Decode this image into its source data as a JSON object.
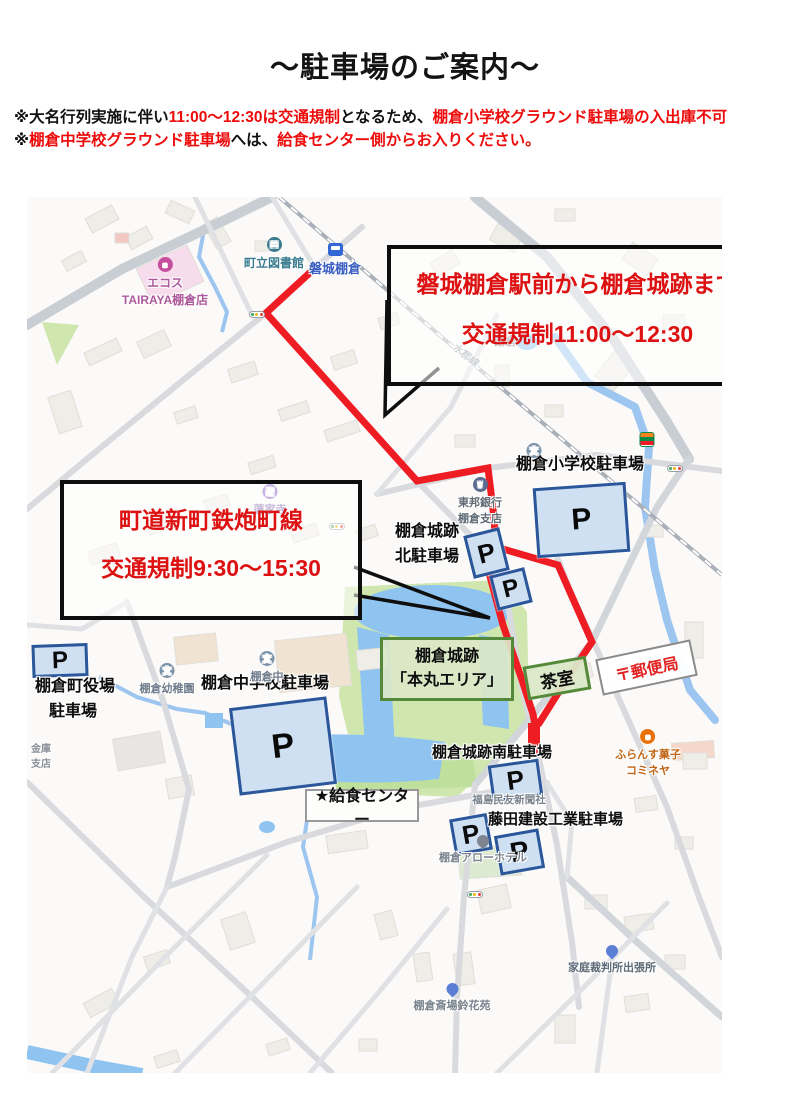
{
  "title": "～駐車場のご案内～",
  "notices": [
    {
      "segments": [
        {
          "text": "※大名行列実施に伴い",
          "color": "black"
        },
        {
          "text": "11:00～12:30は交通規制",
          "color": "red"
        },
        {
          "text": "となるため、",
          "color": "black"
        },
        {
          "text": "棚倉小学校グラウンド駐車場の入出庫不可",
          "color": "red"
        }
      ]
    },
    {
      "segments": [
        {
          "text": "※",
          "color": "black"
        },
        {
          "text": "棚倉中学校グラウンド駐車場",
          "color": "red"
        },
        {
          "text": "へは、",
          "color": "black"
        },
        {
          "text": "給食センター側からお入りください。",
          "color": "red"
        }
      ]
    }
  ],
  "map": {
    "callouts": [
      {
        "id": "station-restriction-callout",
        "lines": [
          "磐城棚倉駅前から棚倉城跡まで",
          "交通規制11:00～12:30"
        ]
      },
      {
        "id": "road-restriction-callout",
        "lines": [
          "町道新町鉄炮町線",
          "交通規制9:30～15:30"
        ]
      }
    ],
    "p_symbol": "P",
    "parking_areas": [
      {
        "id": "shogakko",
        "name": "棚倉小学校駐車場"
      },
      {
        "id": "kita1",
        "name": "棚倉城跡北駐車場"
      },
      {
        "id": "kita2",
        "name": "棚倉城跡北駐車場"
      },
      {
        "id": "yakuba",
        "name": "棚倉町役場駐車場"
      },
      {
        "id": "chugakko",
        "name": "棚倉中学校駐車場"
      },
      {
        "id": "minami",
        "name": "棚倉城跡南駐車場"
      },
      {
        "id": "fujita1",
        "name": "藤田建設工業駐車場"
      },
      {
        "id": "fujita2",
        "name": "藤田建設工業駐車場"
      }
    ],
    "parking_labels": [
      {
        "id": "shogakko-parking",
        "lines": [
          "棚倉小学校駐車場"
        ]
      },
      {
        "id": "joseki-kita-parking",
        "lines": [
          "棚倉城跡",
          "北駐車場"
        ]
      },
      {
        "id": "yakuba-parking",
        "lines": [
          "棚倉町役場",
          "駐車場"
        ]
      },
      {
        "id": "chugakko-parking",
        "lines": [
          "棚倉中学校駐車場"
        ]
      },
      {
        "id": "joseki-minami-parking",
        "lines": [
          "棚倉城跡南駐車場"
        ]
      },
      {
        "id": "fujita-parking",
        "lines": [
          "藤田建設工業駐車場"
        ]
      }
    ],
    "area_boxes": {
      "honmaru": {
        "lines": [
          "棚倉城跡",
          "「本丸エリア」"
        ]
      },
      "chashitsu": {
        "label": "茶室"
      },
      "post_office": {
        "label": "〒郵便局"
      },
      "kyushoku": {
        "label": "★給食センター"
      }
    },
    "pois": [
      {
        "id": "ecos",
        "lines": [
          "エコス",
          "TAIRAYA棚倉店"
        ],
        "icon": "shopping-icon"
      },
      {
        "id": "library",
        "lines": [
          "町立図書館"
        ],
        "icon": "library-icon"
      },
      {
        "id": "station",
        "lines": [
          "磐城棚倉"
        ],
        "icon": "train-icon"
      },
      {
        "id": "town",
        "lines": [
          "棚倉"
        ],
        "icon": ""
      },
      {
        "id": "suigun-line",
        "lines": [
          "水郡線"
        ],
        "icon": ""
      },
      {
        "id": "renkeji",
        "lines": [
          "蓮家寺"
        ],
        "icon": "temple-icon"
      },
      {
        "id": "toho-bank",
        "lines": [
          "東邦銀行",
          "棚倉支店"
        ],
        "icon": "bank-icon"
      },
      {
        "id": "yochien",
        "lines": [
          "棚倉幼稚園"
        ],
        "icon": "school-icon"
      },
      {
        "id": "chugaku",
        "lines": [
          "棚倉中"
        ],
        "icon": "school-icon"
      },
      {
        "id": "shogakko-school",
        "lines": [],
        "icon": "school-icon"
      },
      {
        "id": "seven-eleven",
        "lines": [],
        "icon": "seven-eleven-icon"
      },
      {
        "id": "komineya",
        "lines": [
          "ふらんす菓子",
          "コミネヤ"
        ],
        "icon": "cafe-icon"
      },
      {
        "id": "arrow-hotel",
        "lines": [
          "棚倉アローホテル"
        ],
        "icon": "hotel-pin-icon"
      },
      {
        "id": "shimbun",
        "lines": [
          "福島民友新聞社"
        ],
        "icon": ""
      },
      {
        "id": "court",
        "lines": [
          "家庭裁判所出張所"
        ],
        "icon": "pin-icon"
      },
      {
        "id": "saijo",
        "lines": [
          "棚倉斎場鈴花苑"
        ],
        "icon": "pin-icon"
      },
      {
        "id": "kinko",
        "lines": [
          "金庫",
          "支店"
        ],
        "icon": ""
      }
    ],
    "colors": {
      "restriction_route_red": "#ee1c23",
      "callout_text_red": "#dd1111",
      "notice_red": "#ee0b0b",
      "parking_fill": "#cfe0f3",
      "parking_border": "#2b579a",
      "area_green_border": "#55893a",
      "area_green_fill": "#dbe8c8",
      "water_blue": "#8fc3f0",
      "park_green": "#cfe7ae"
    }
  }
}
